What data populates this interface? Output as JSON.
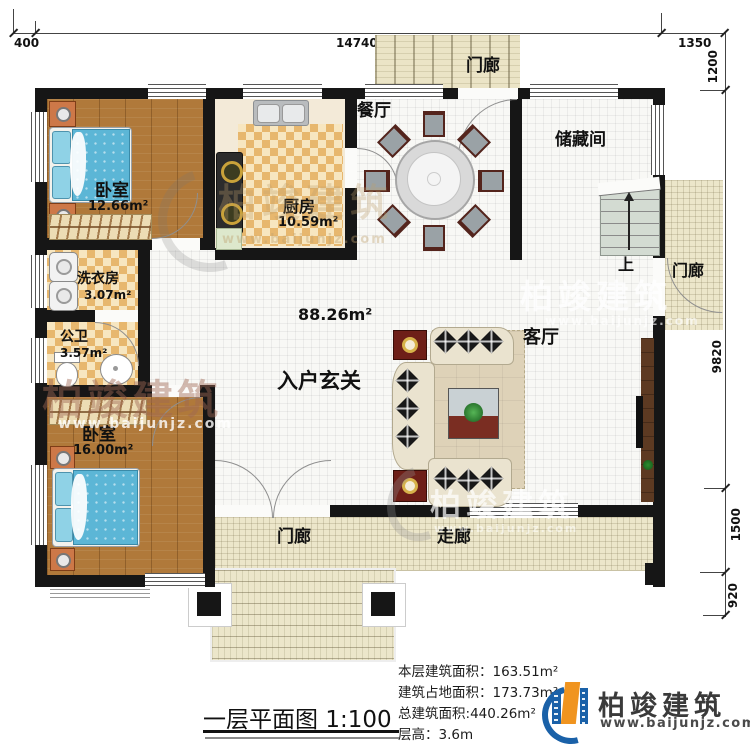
{
  "title_block": {
    "title": "一层平面图",
    "scale": "1:100"
  },
  "info": {
    "lines": [
      {
        "label": "本层建筑面积：",
        "value": "163.51m²"
      },
      {
        "label": "建筑占地面积：",
        "value": "173.73m²"
      },
      {
        "label": "总建筑面积:",
        "value": "440.26m²"
      },
      {
        "label": "层高：",
        "value": "3.6m"
      }
    ]
  },
  "logo": {
    "name": "柏竣建筑",
    "url": "www.baijunjz.com"
  },
  "watermark": {
    "name": "柏竣建筑",
    "url": "www.baijunjz.com"
  },
  "dimensions": {
    "top": [
      "400",
      "14740",
      "1350"
    ],
    "right": [
      "1200",
      "9820",
      "1500",
      "920"
    ]
  },
  "rooms": {
    "porch_top": {
      "label": "门廊"
    },
    "bedroom1": {
      "label": "卧室",
      "area": "12.66m²"
    },
    "kitchen": {
      "label": "厨房",
      "area": "10.59m²"
    },
    "dining": {
      "label": "餐厅"
    },
    "storage": {
      "label": "储藏间"
    },
    "stairs": {
      "label": "上"
    },
    "porch_right": {
      "label": "门廊"
    },
    "laundry": {
      "label": "洗衣房",
      "area": "3.07m²"
    },
    "bathroom": {
      "label": "公卫",
      "area": "3.57m²"
    },
    "foyer": {
      "label": "入户玄关",
      "area": "88.26m²"
    },
    "living": {
      "label": "客厅"
    },
    "bedroom2": {
      "label": "卧室",
      "area": "16.00m²"
    },
    "porch_bottom": {
      "label": "门廊"
    },
    "corridor": {
      "label": "走廊"
    }
  },
  "colors": {
    "wall": "#161616",
    "wood_floor": "#b0793a",
    "checker_floor": "#e7b76e",
    "porch": "#ece6ca",
    "bed": "#5cb6d6",
    "logo_blue": "#1a61a8",
    "logo_orange": "#f0941f"
  }
}
